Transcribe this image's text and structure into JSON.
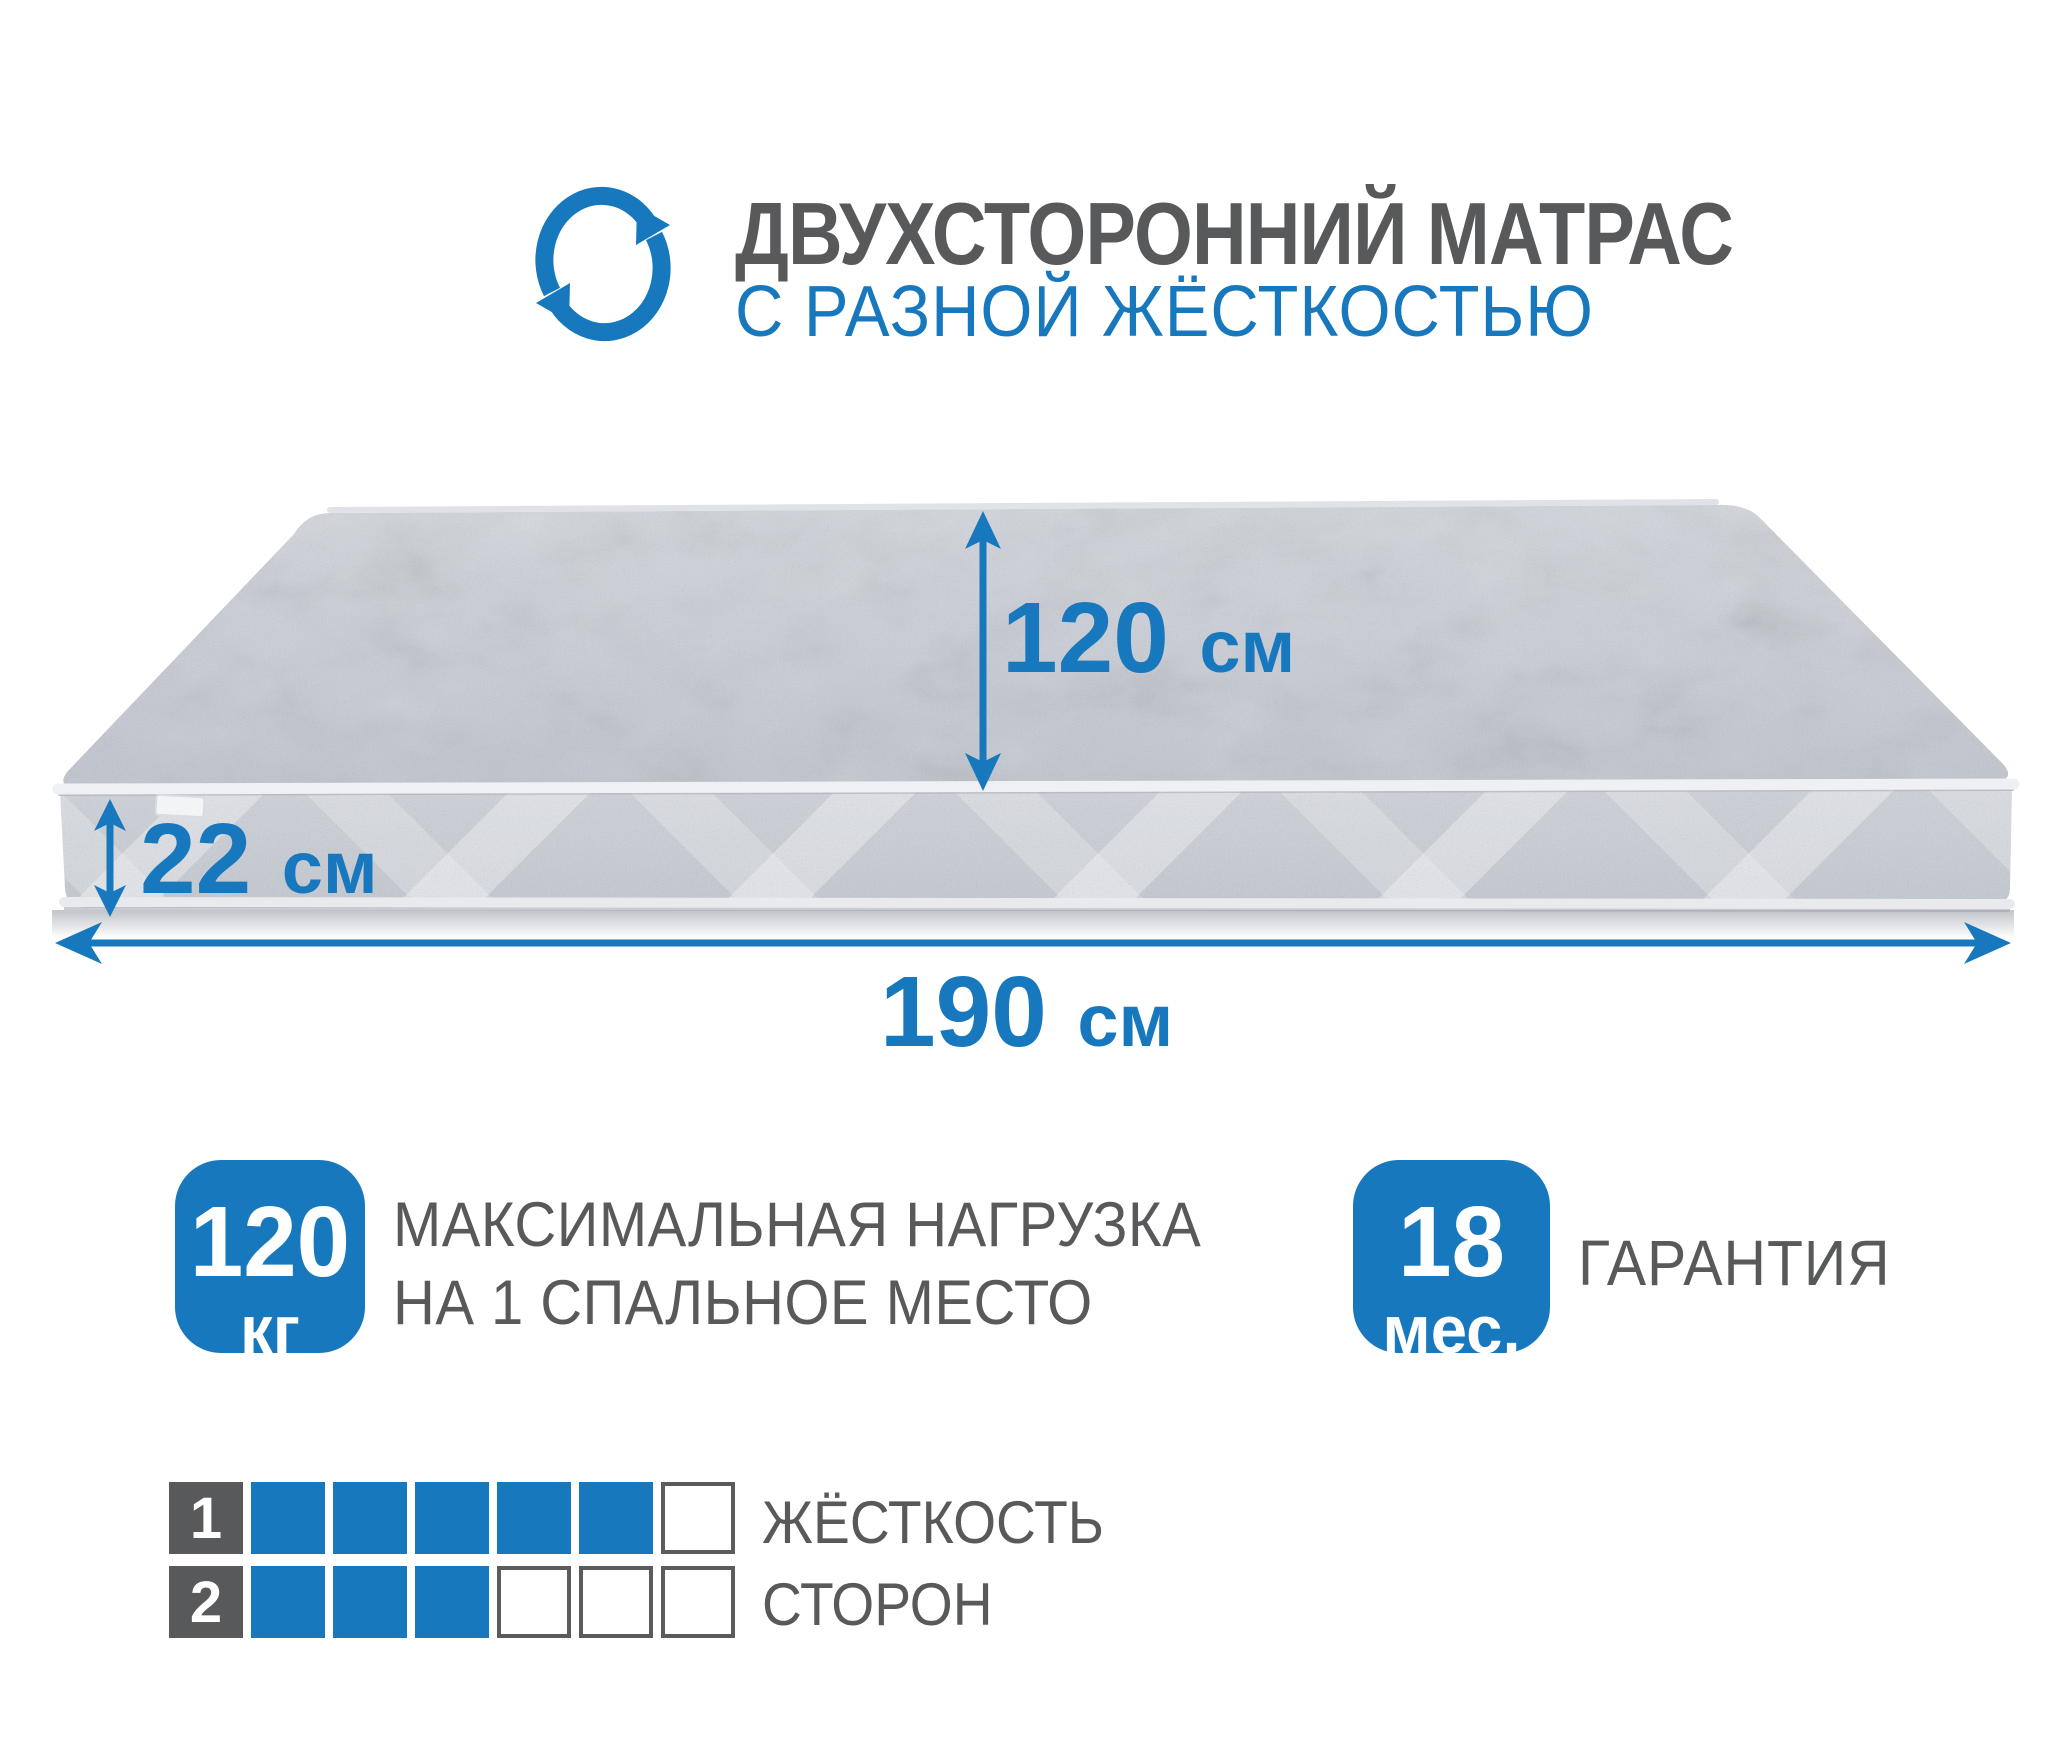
{
  "header": {
    "title": "ДВУХСТОРОННИЙ МАТРАС",
    "subtitle": "С РАЗНОЙ ЖЁСТКОСТЬЮ",
    "icon": "rotate-arrows-icon"
  },
  "dimensions": {
    "width": {
      "value": "120",
      "unit": "см"
    },
    "thickness": {
      "value": "22",
      "unit": "см"
    },
    "length": {
      "value": "190",
      "unit": "см"
    }
  },
  "badges": {
    "max_load": {
      "value": "120",
      "unit": "кг",
      "label_line1": "МАКСИМАЛЬНАЯ НАГРУЗКА",
      "label_line2": "НА 1 СПАЛЬНОЕ МЕСТО"
    },
    "warranty": {
      "value": "18",
      "unit": "мес.",
      "label": "ГАРАНТИЯ"
    }
  },
  "hardness_scale": {
    "caption_line1": "ЖЁСТКОСТЬ",
    "caption_line2": "СТОРОН",
    "rows": [
      {
        "label": "1",
        "filled": 5,
        "total": 6
      },
      {
        "label": "2",
        "filled": 3,
        "total": 6
      }
    ]
  },
  "colors": {
    "accent_blue": "#1878be",
    "text_gray": "#58595b",
    "mattress_top": "#c6cbd3",
    "mattress_side": "#c9cdd5"
  }
}
